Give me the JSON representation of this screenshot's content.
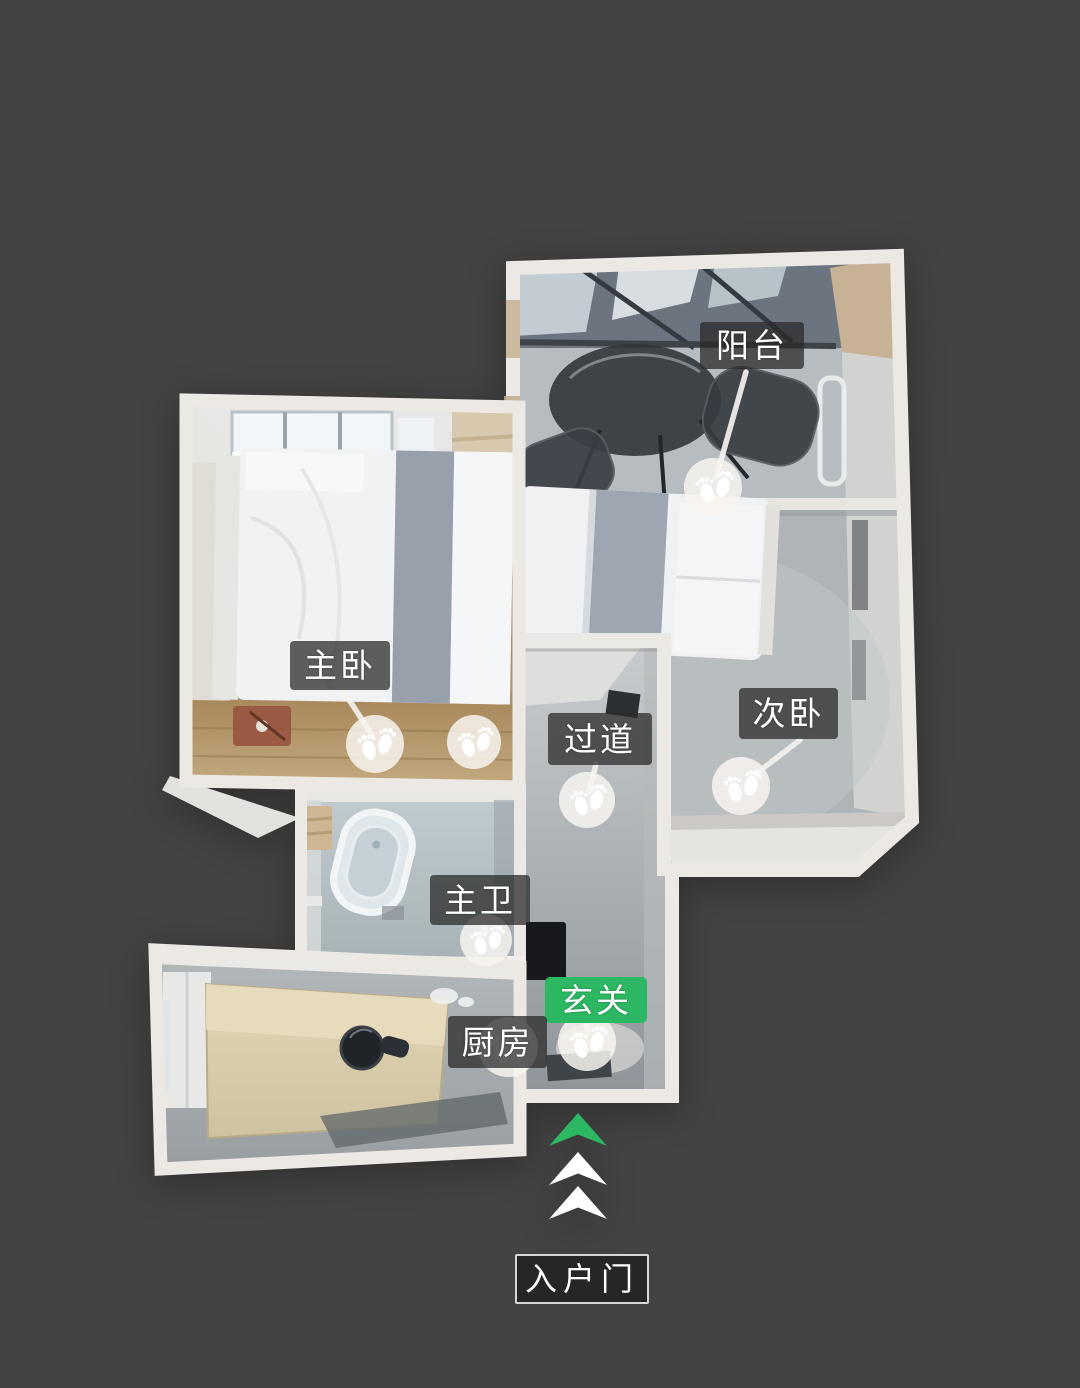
{
  "floorplan": {
    "view_type": "3d-dollhouse-top-view",
    "background_color": "#434343",
    "wall_color": "#ece9e5",
    "label_background": "rgba(41,41,41,0.74)",
    "label_text_color": "#ffffff",
    "highlight_green": "#2cb863",
    "rooms": [
      {
        "id": "balcony",
        "label": "阳台",
        "highlighted": false
      },
      {
        "id": "master-bedroom",
        "label": "主卧",
        "highlighted": false
      },
      {
        "id": "second-bedroom",
        "label": "次卧",
        "highlighted": false
      },
      {
        "id": "hallway",
        "label": "过道",
        "highlighted": false
      },
      {
        "id": "master-bathroom",
        "label": "主卫",
        "highlighted": false
      },
      {
        "id": "entryway",
        "label": "玄关",
        "highlighted": true
      },
      {
        "id": "kitchen",
        "label": "厨房",
        "highlighted": false
      }
    ],
    "waypoints": [
      {
        "room": "balcony",
        "icon": "footprints-icon"
      },
      {
        "room": "master-bedroom",
        "icon": "footprints-icon"
      },
      {
        "room": "master-bedroom",
        "icon": "footprints-icon"
      },
      {
        "room": "hallway",
        "icon": "footprints-icon"
      },
      {
        "room": "second-bedroom",
        "icon": "footprints-icon"
      },
      {
        "room": "master-bathroom",
        "icon": "footprints-icon"
      },
      {
        "room": "entryway",
        "icon": "footprints-icon"
      },
      {
        "room": "kitchen",
        "icon": "footprints-icon"
      }
    ],
    "entrance": {
      "door_label": "入户门",
      "arrows": [
        {
          "icon": "chevron-up-arrow",
          "color": "#2cb863"
        },
        {
          "icon": "chevron-up-arrow",
          "color": "#ffffff"
        },
        {
          "icon": "chevron-up-arrow",
          "color": "#ffffff"
        }
      ]
    }
  }
}
